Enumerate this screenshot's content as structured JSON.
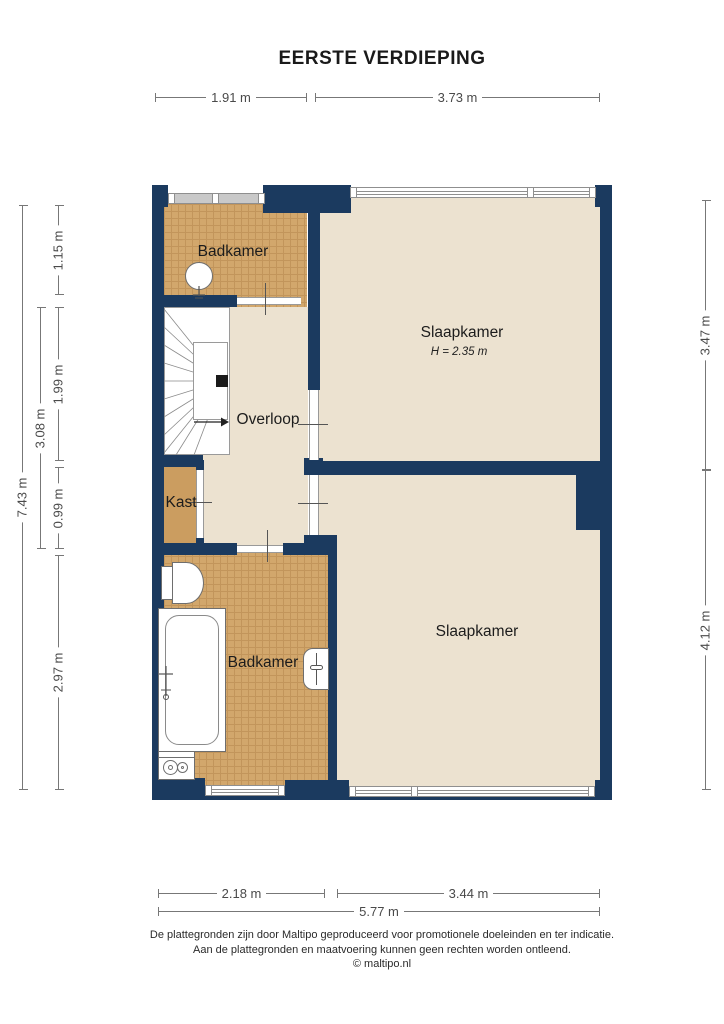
{
  "title": "EERSTE VERDIEPING",
  "rooms": {
    "badkamer_top": {
      "label": "Badkamer"
    },
    "slaapkamer_top": {
      "label": "Slaapkamer",
      "height_note": "H = 2.35 m"
    },
    "overloop": {
      "label": "Overloop"
    },
    "kast": {
      "label": "Kast"
    },
    "badkamer_bottom": {
      "label": "Badkamer"
    },
    "slaapkamer_bottom": {
      "label": "Slaapkamer"
    }
  },
  "dimensions": {
    "top": {
      "left": "1.91 m",
      "right": "3.73 m"
    },
    "bottom": {
      "left": "2.18 m",
      "right": "3.44 m",
      "total": "5.77 m"
    },
    "left": {
      "total": "7.43 m",
      "middle": "3.08 m",
      "seg1": "1.15 m",
      "seg2": "1.99 m",
      "seg3": "0.99 m",
      "seg4": "2.97 m"
    },
    "right": {
      "seg1": "3.47 m",
      "seg2": "4.12 m"
    }
  },
  "footer": {
    "line1": "De plattegronden zijn door Maltipo geproduceerd voor promotionele doeleinden en ter indicatie.",
    "line2": "Aan de plattegronden en maatvoering kunnen geen rechten worden ontleend.",
    "line3": "© maltipo.nl"
  },
  "colors": {
    "wall": "#1b3a5f",
    "tile_floor": "#d2a76c",
    "tile_grid": "#c2955b",
    "room_floor": "#ece2d0",
    "tan_floor": "#cb9d60",
    "window_band": "#c9c9c9",
    "dim": "#777777",
    "text": "#1a1a1a"
  }
}
